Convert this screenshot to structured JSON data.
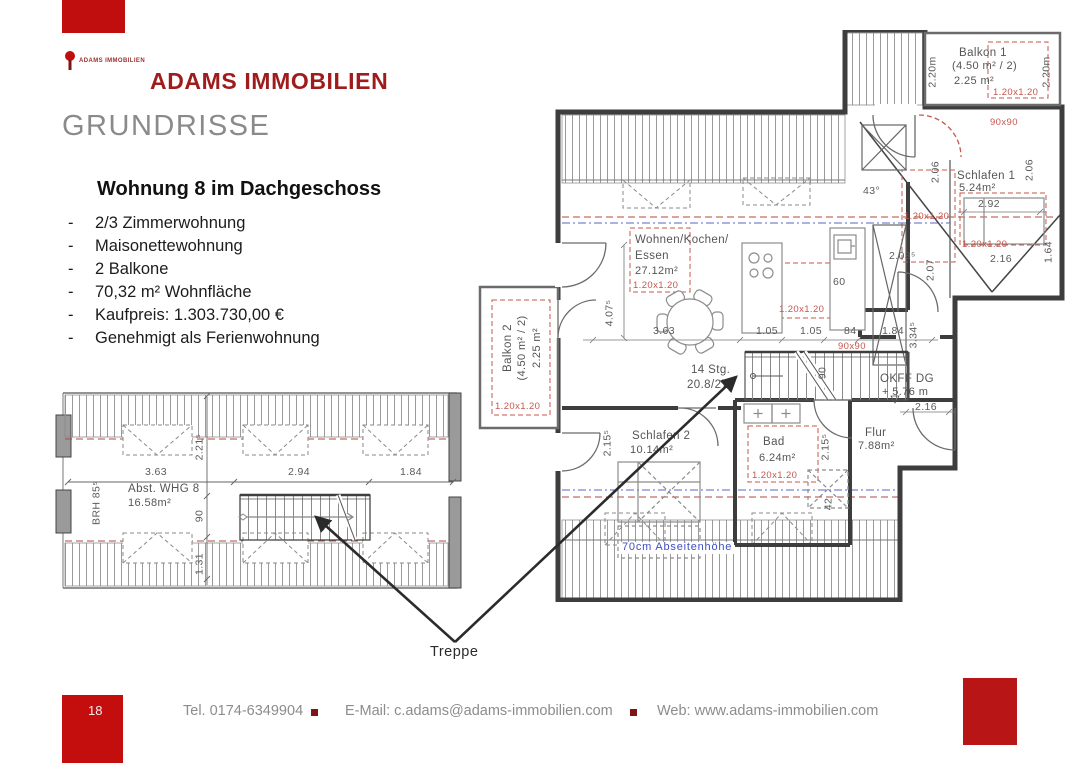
{
  "header": {
    "logo_caption": "ADAMS IMMOBILIEN",
    "brand": "ADAMS IMMOBILIEN",
    "page_title": "GRUNDRISSE"
  },
  "listing": {
    "heading": "Wohnung 8 im Dachgeschoss",
    "marker": "-",
    "bullets": [
      "2/3 Zimmerwohnung",
      "Maisonettewohnung",
      "2 Balkone",
      "70,32 m² Wohnfläche",
      "Kaufpreis: 1.303.730,00 €",
      "Genehmigt als Ferienwohnung"
    ]
  },
  "plan_main": {
    "balkon1": {
      "name": "Balkon 1",
      "size": "(4.50 m² / 2)",
      "area": "2.25 m²",
      "window": "1.20x1.20",
      "height_left": "2.20m",
      "height_right": "2.20m"
    },
    "balkon2": {
      "name": "Balkon 2",
      "size": "(4.50 m² / 2)",
      "area": "2.25 m²",
      "window": "1.20x1.20"
    },
    "wohnen": {
      "name1": "Wohnen/Kochen/",
      "name2": "Essen",
      "area": "27.12m²",
      "window": "1.20x1.20"
    },
    "schlafen1": {
      "name": "Schlafen 1",
      "area": "5.24m²",
      "width": "2.92",
      "dim_left": "2.06",
      "dim_right": "2.06",
      "door": "90x90",
      "window1": "1.20x1.20",
      "window2": "1.20x1.20",
      "dim216": "2.16",
      "dim164": "1.64"
    },
    "schlafen2": {
      "name": "Schlafen 2",
      "area": "10.14m²"
    },
    "bad": {
      "name": "Bad",
      "area": "6.24m²",
      "window": "1.20x1.20"
    },
    "flur": {
      "name": "Flur",
      "area": "7.88m²"
    },
    "stairs": {
      "line1": "14 Stg.",
      "line2": "20.8/27⁵",
      "width": "90"
    },
    "okff": {
      "line1": "OKFF DG",
      "line2": "+ 5.76 m",
      "dim": "2.16"
    },
    "dims": {
      "d407": "4.07⁵",
      "d363": "3.63",
      "d105a": "1.05",
      "d105b": "1.05",
      "d84": "84",
      "d184": "1.84",
      "win90": "90x90",
      "kitchen_window": "1.20x1.20",
      "angle": "43°",
      "d203": "2.03⁵",
      "d207": "2.07",
      "d60": "60",
      "d334": "3.34⁵",
      "d215a": "2.15⁵",
      "d215b": "2.15⁵",
      "d42": "42"
    },
    "abseiten_note": "70cm Abseitenhöhe"
  },
  "plan_lower": {
    "abst": {
      "name": "Abst. WHG 8",
      "area": "16.58m²"
    },
    "brh": "BRH 85⁵",
    "dims": {
      "d363": "3.63",
      "d294": "2.94",
      "d184": "1.84",
      "d221": "2.21⁵",
      "d90": "90",
      "d131": "1.31"
    }
  },
  "treppe_label": "Treppe",
  "footer": {
    "page_number": "18",
    "tel": "Tel. 0174-6349904",
    "email": "E-Mail: c.adams@adams-immobilien.com",
    "web": "Web: www.adams-immobilien.com"
  },
  "colors": {
    "brand_red": "#c00d0d",
    "title_red": "#9e1c1c",
    "annotation_red": "#c4574e",
    "annotation_blue": "#3d4fc4",
    "plan_line": "#4a4a4a",
    "footer_gray": "#8c8c8c"
  }
}
